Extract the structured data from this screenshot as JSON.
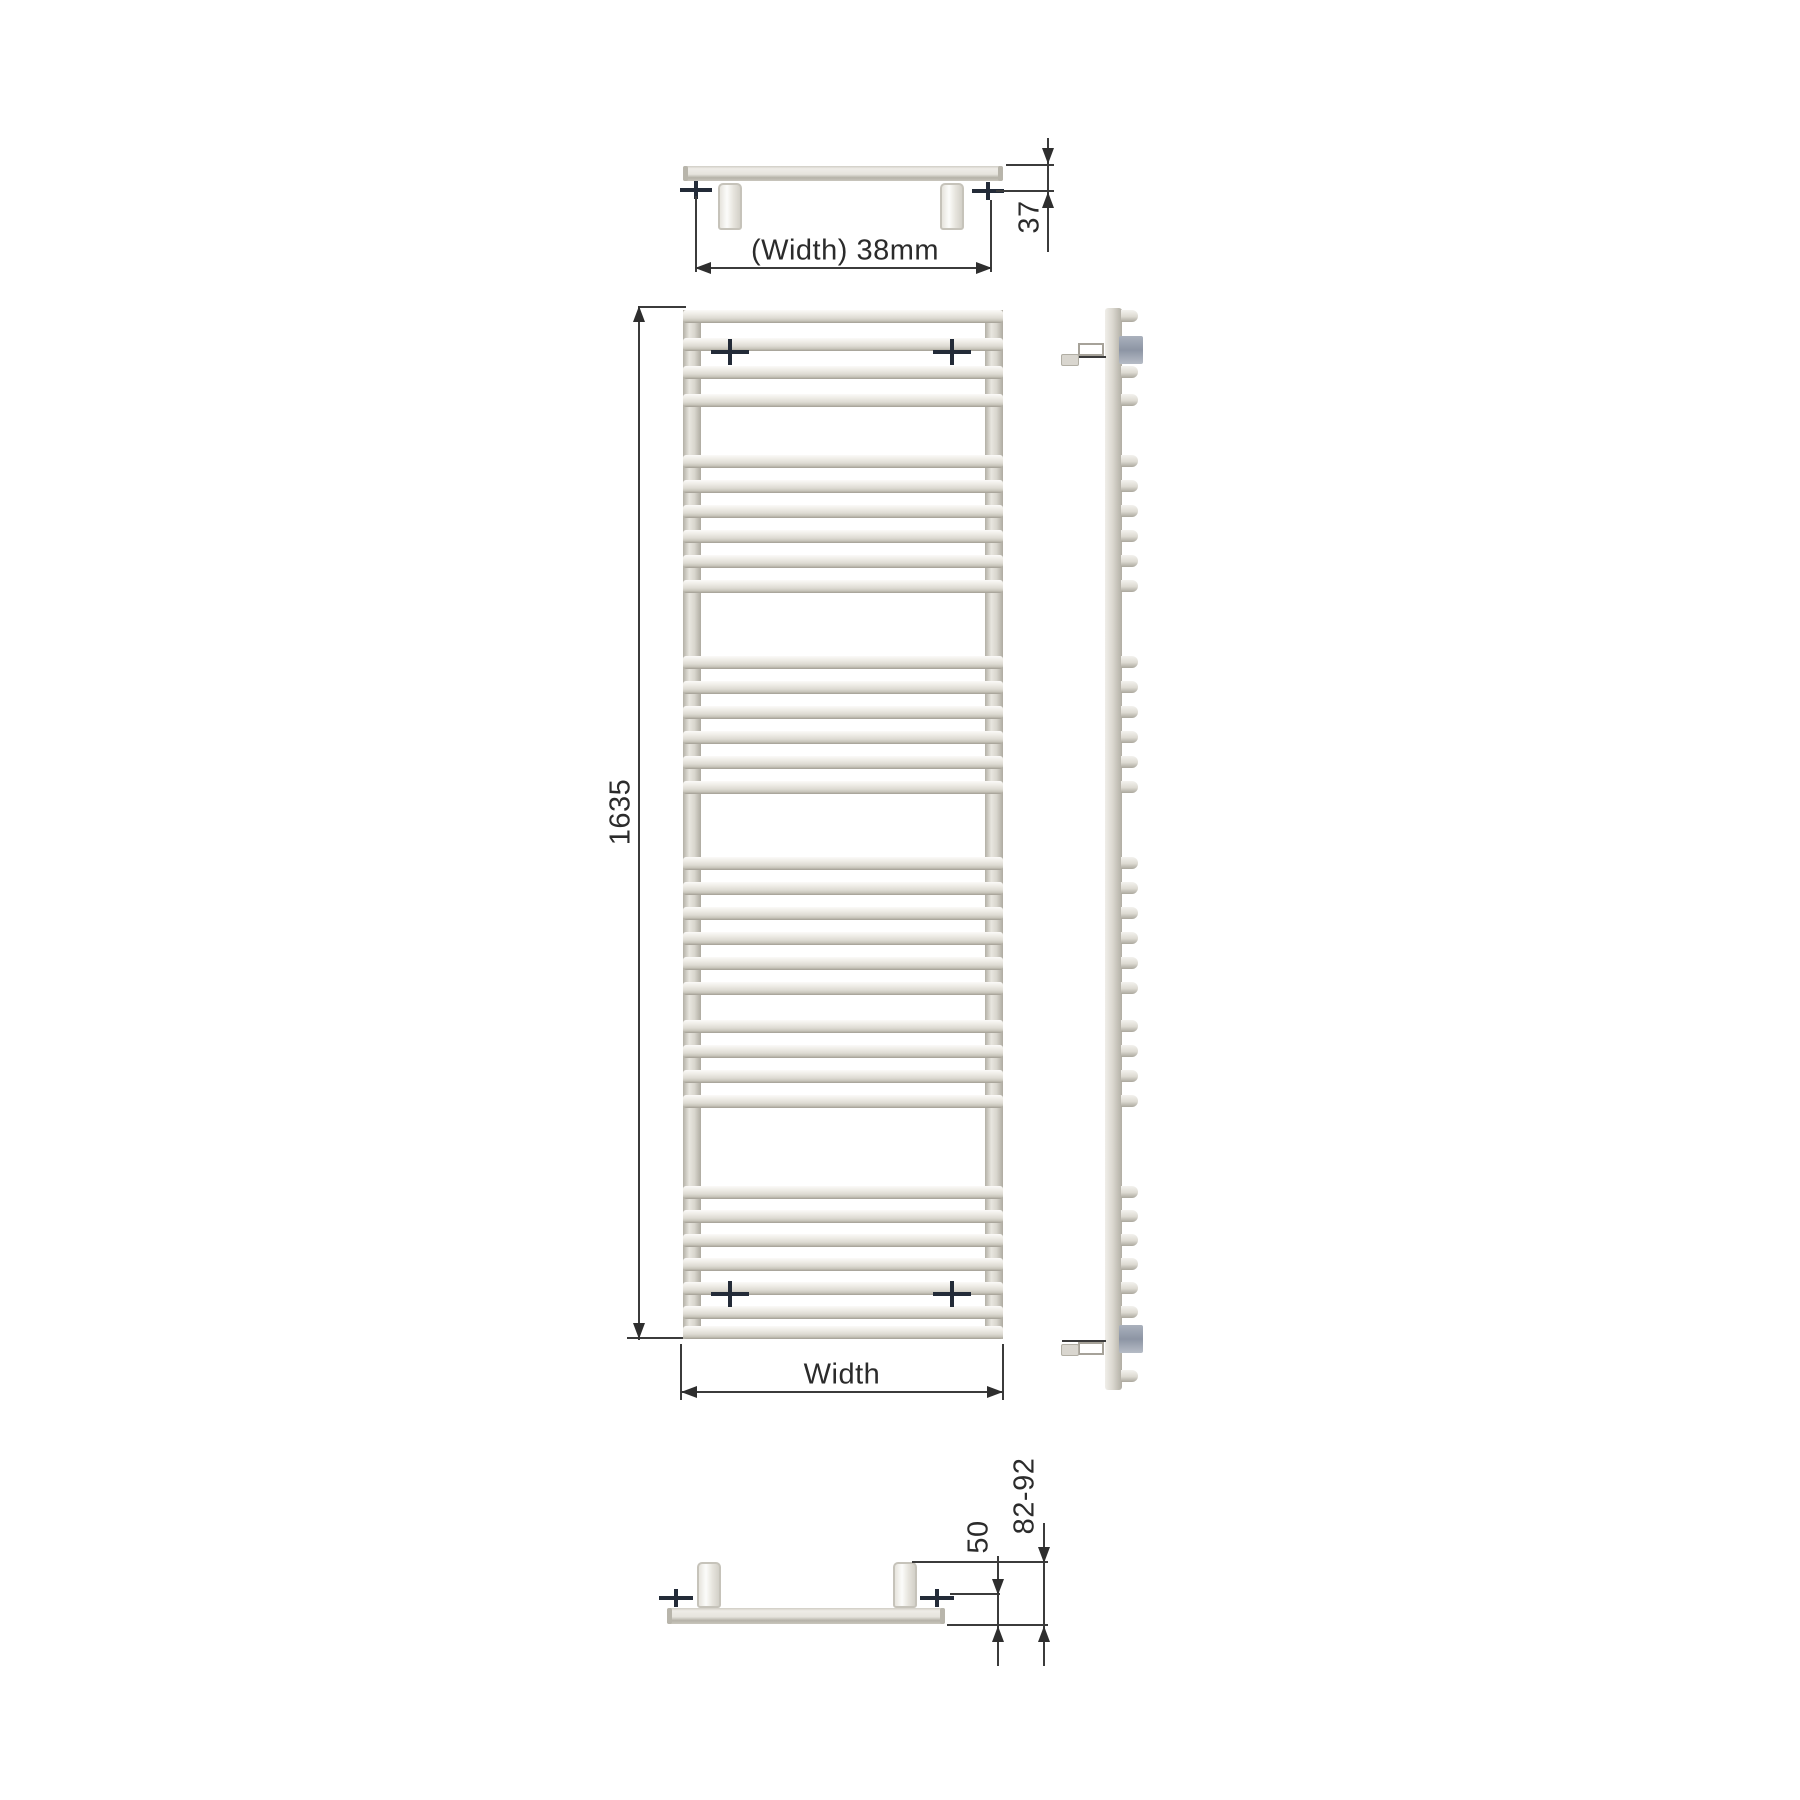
{
  "labels": {
    "top_width": "(Width) 38mm",
    "top_depth": "37",
    "height": "1635",
    "front_width": "Width",
    "bottom_offset": "50",
    "bottom_range": "82-92"
  },
  "colors": {
    "dimension_line": "#3b3b3b",
    "arrow": "#2e2e2e",
    "text": "#2b2b2b",
    "mount_cross": "#232b38",
    "radiator_light": "#efede8",
    "radiator_shadow": "#a29e93",
    "bracket_block": "#8d95a4",
    "background": "#ffffff"
  },
  "front_view": {
    "x": 683,
    "width": 320,
    "top": 310,
    "bottom": 1339,
    "tube_xs": [
      683,
      985
    ],
    "tube_width": 18,
    "rung_height": 13,
    "rung_ys": [
      310,
      338,
      366,
      394,
      455,
      480,
      505,
      530,
      555,
      580,
      656,
      681,
      706,
      731,
      756,
      781,
      857,
      882,
      907,
      932,
      957,
      982,
      1020,
      1045,
      1070,
      1095,
      1186,
      1210,
      1234,
      1258,
      1282,
      1306,
      1326
    ],
    "crosses": [
      [
        730,
        352
      ],
      [
        952,
        352
      ],
      [
        730,
        1294
      ],
      [
        952,
        1294
      ]
    ],
    "cross_h": 38,
    "cross_v": 26,
    "lines": [
      {
        "x": 638,
        "y": 306,
        "w": 48,
        "h": 2
      },
      {
        "x": 638,
        "y": 306,
        "w": 2,
        "h": 1034
      },
      {
        "x": 627,
        "y": 1337,
        "w": 56,
        "h": 2
      },
      {
        "x": 680,
        "y": 1344,
        "w": 2,
        "h": 56
      },
      {
        "x": 1002,
        "y": 1344,
        "w": 2,
        "h": 56
      },
      {
        "x": 681,
        "y": 1391,
        "w": 322,
        "h": 2
      }
    ],
    "arrows": [
      {
        "x": 639,
        "y": 306,
        "dir": "up"
      },
      {
        "x": 639,
        "y": 1339,
        "dir": "down"
      },
      {
        "x": 681,
        "y": 1392,
        "dir": "left"
      },
      {
        "x": 1003,
        "y": 1392,
        "dir": "right"
      }
    ]
  },
  "side_view": {
    "bar_x": 1105,
    "bar_width": 17,
    "top": 308,
    "bottom": 1390,
    "stub_x": 1121,
    "stub_width": 17,
    "stub_height": 12,
    "stub_ys": [
      310,
      338,
      366,
      394,
      455,
      480,
      505,
      530,
      555,
      580,
      656,
      681,
      706,
      731,
      756,
      781,
      857,
      882,
      907,
      932,
      957,
      982,
      1020,
      1045,
      1070,
      1095,
      1186,
      1210,
      1234,
      1258,
      1282,
      1306,
      1370
    ],
    "blocks": [
      {
        "x": 1119,
        "y": 336,
        "w": 24,
        "h": 28
      },
      {
        "x": 1119,
        "y": 1325,
        "w": 24,
        "h": 28
      }
    ],
    "arms": [
      {
        "line": {
          "x": 1062,
          "y": 356,
          "w": 44,
          "h": 2
        },
        "rect": {
          "x": 1078,
          "y": 343,
          "w": 26,
          "h": 13
        },
        "stub": {
          "x": 1061,
          "y": 354,
          "w": 18,
          "h": 12
        }
      },
      {
        "line": {
          "x": 1062,
          "y": 1340,
          "w": 44,
          "h": 2
        },
        "rect": {
          "x": 1078,
          "y": 1342,
          "w": 26,
          "h": 13
        },
        "stub": {
          "x": 1061,
          "y": 1344,
          "w": 18,
          "h": 12
        }
      }
    ]
  },
  "top_view": {
    "bar": {
      "x": 683,
      "y": 166,
      "w": 320,
      "h": 15
    },
    "valves": [
      {
        "x": 718,
        "y": 183,
        "w": 24,
        "h": 47
      },
      {
        "x": 940,
        "y": 183,
        "w": 24,
        "h": 47
      }
    ],
    "crosses": [
      [
        696,
        190
      ],
      [
        988,
        191
      ]
    ],
    "cross_h": 32,
    "cross_v": 18,
    "lines": [
      {
        "x": 1006,
        "y": 164,
        "w": 48,
        "h": 2
      },
      {
        "x": 996,
        "y": 190,
        "w": 58,
        "h": 2
      },
      {
        "x": 1047,
        "y": 138,
        "w": 2,
        "h": 114
      },
      {
        "x": 695,
        "y": 196,
        "w": 2,
        "h": 76
      },
      {
        "x": 990,
        "y": 200,
        "w": 2,
        "h": 72
      },
      {
        "x": 695,
        "y": 267,
        "w": 297,
        "h": 2
      }
    ],
    "arrows": [
      {
        "x": 1048,
        "y": 164,
        "dir": "down"
      },
      {
        "x": 1048,
        "y": 192,
        "dir": "up"
      },
      {
        "x": 695,
        "y": 268,
        "dir": "left"
      },
      {
        "x": 992,
        "y": 268,
        "dir": "right"
      }
    ]
  },
  "bottom_view": {
    "bar": {
      "x": 667,
      "y": 1608,
      "w": 278,
      "h": 16
    },
    "valves": [
      {
        "x": 697,
        "y": 1562,
        "w": 24,
        "h": 46
      },
      {
        "x": 893,
        "y": 1562,
        "w": 24,
        "h": 46
      }
    ],
    "crosses": [
      [
        676,
        1598
      ],
      [
        937,
        1598
      ]
    ],
    "cross_h": 34,
    "cross_v": 18,
    "lines": [
      {
        "x": 912,
        "y": 1561,
        "w": 136,
        "h": 2
      },
      {
        "x": 950,
        "y": 1593,
        "w": 50,
        "h": 2
      },
      {
        "x": 947,
        "y": 1624,
        "w": 101,
        "h": 2
      },
      {
        "x": 997,
        "y": 1556,
        "w": 2,
        "h": 110
      },
      {
        "x": 1043,
        "y": 1523,
        "w": 2,
        "h": 143
      }
    ],
    "arrows": [
      {
        "x": 998,
        "y": 1595,
        "dir": "down"
      },
      {
        "x": 998,
        "y": 1626,
        "dir": "up"
      },
      {
        "x": 1044,
        "y": 1563,
        "dir": "down"
      },
      {
        "x": 1044,
        "y": 1626,
        "dir": "up"
      }
    ]
  }
}
